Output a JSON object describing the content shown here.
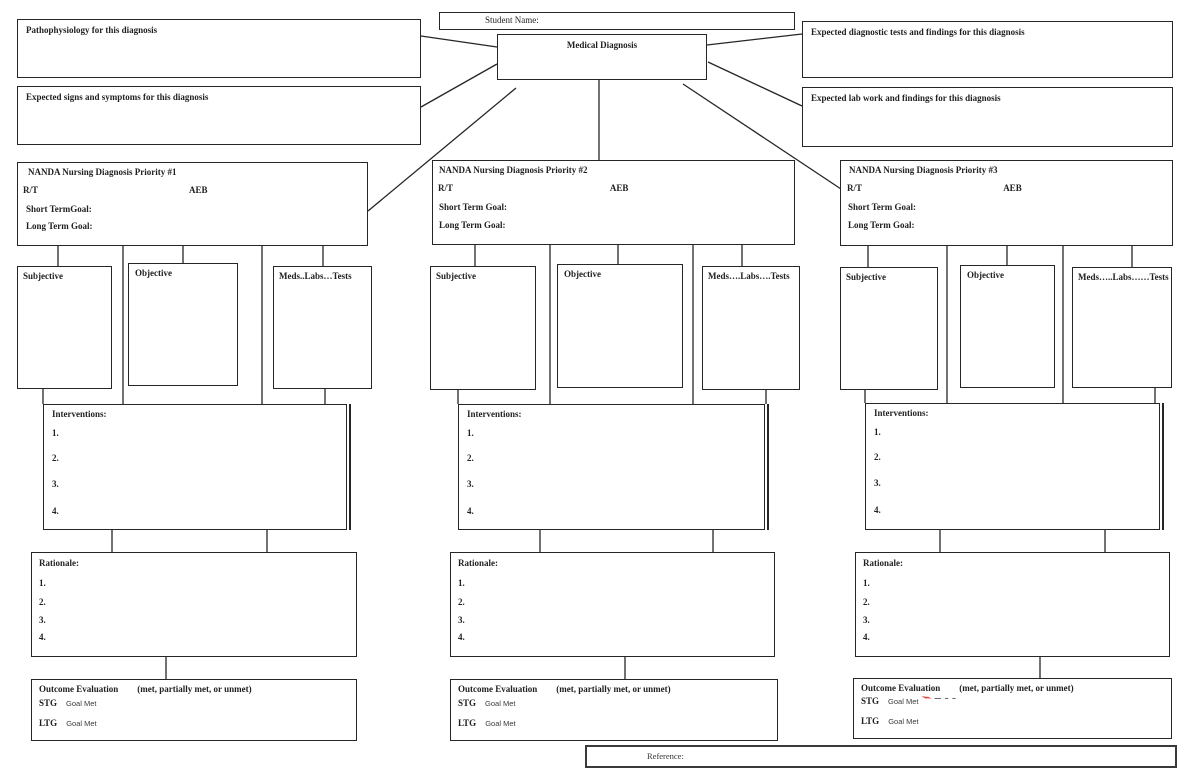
{
  "colors": {
    "ink": "#262626",
    "annotation_red": "#e8413c"
  },
  "header": {
    "student_name_label": "Student Name:",
    "medical_diagnosis_label": "Medical Diagnosis",
    "pathophysiology_label": "Pathophysiology for this diagnosis",
    "signs_symptoms_label": "Expected signs and symptoms for this diagnosis",
    "diagnostic_tests_label": "Expected diagnostic tests and findings for this diagnosis",
    "lab_work_label": "Expected lab work and findings for this diagnosis"
  },
  "footer": {
    "reference_label": "Reference:"
  },
  "columns": [
    {
      "nanda_title": "NANDA Nursing Diagnosis Priority #1",
      "rt_label": "R/T",
      "aeb_label": "AEB",
      "short_term_goal_label": "Short TermGoal:",
      "long_term_goal_label": "Long Term Goal:",
      "subjective_label": "Subjective",
      "objective_label": "Objective",
      "meds_label": "Meds..Labs…Tests",
      "interventions_label": "Interventions:",
      "interventions_items": [
        "1.",
        "2.",
        "3.",
        "4."
      ],
      "rationale_label": "Rationale:",
      "rationale_items": [
        "1.",
        "2.",
        "3.",
        "4."
      ],
      "outcome_label": "Outcome Evaluation",
      "outcome_note": "(met, partially met, or unmet)",
      "stg_label": "STG",
      "stg_value": "Goal Met",
      "ltg_label": "LTG",
      "ltg_value": "Goal Met"
    },
    {
      "nanda_title": "NANDA Nursing Diagnosis Priority #2",
      "rt_label": "R/T",
      "aeb_label": "AEB",
      "short_term_goal_label": "Short Term Goal:",
      "long_term_goal_label": "Long Term Goal:",
      "subjective_label": "Subjective",
      "objective_label": "Objective",
      "meds_label": "Meds….Labs….Tests",
      "interventions_label": "Interventions:",
      "interventions_items": [
        "1.",
        "2.",
        "3.",
        "4."
      ],
      "rationale_label": "Rationale:",
      "rationale_items": [
        "1.",
        "2.",
        "3.",
        "4."
      ],
      "outcome_label": "Outcome Evaluation",
      "outcome_note": "(met, partially met, or unmet)",
      "stg_label": "STG",
      "stg_value": "Goal Met",
      "ltg_label": "LTG",
      "ltg_value": "Goal Met"
    },
    {
      "nanda_title": "NANDA Nursing Diagnosis Priority #3",
      "rt_label": "R/T",
      "aeb_label": "AEB",
      "short_term_goal_label": "Short Term Goal:",
      "long_term_goal_label": "Long Term Goal:",
      "subjective_label": "Subjective",
      "objective_label": "Objective",
      "meds_label": "Meds…..Labs……Tests",
      "interventions_label": "Interventions:",
      "interventions_items": [
        "1.",
        "2.",
        "3.",
        "4."
      ],
      "rationale_label": "Rationale:",
      "rationale_items": [
        "1.",
        "2.",
        "3.",
        "4."
      ],
      "outcome_label": "Outcome Evaluation",
      "outcome_note": "(met, partially met, or unmet)",
      "stg_label": "STG",
      "stg_value": "Goal Met",
      "stg_mark_dashes": "— – –",
      "ltg_label": "LTG",
      "ltg_value": "Goal Met"
    }
  ]
}
